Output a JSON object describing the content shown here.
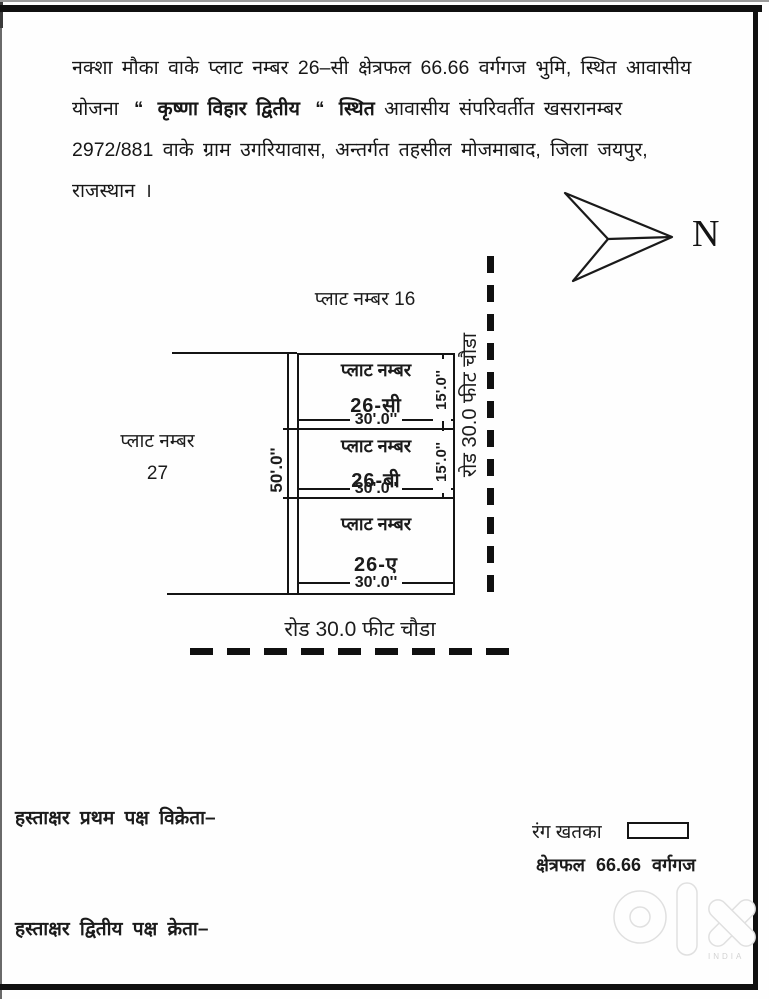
{
  "header_paragraph": {
    "line1": "नक्शा मौका वाके प्लाट नम्बर 26–सी क्षेत्रफल 66.66 वर्गगज भुमि, स्थित आवासीय",
    "line2_prefix": "योजना",
    "line2_quote_open": "‘‘",
    "line2_bold_name": "कृष्णा विहार द्वितीय",
    "line2_quote_close": "‘‘",
    "line2_bold_word": "स्थित",
    "line2_rest": "आवासीय संपरिवर्तीत खसरानम्बर",
    "line3": "2972/881 वाके ग्राम उगरियावास, अन्तर्गत तहसील मोजमाबाद, जिला जयपुर,",
    "line4": "राजस्थान ।"
  },
  "north": {
    "label": "N"
  },
  "diagram": {
    "adjacent_plot_top": "प्लाट नम्बर 16",
    "adjacent_plot_left_line1": "प्लाट नम्बर",
    "adjacent_plot_left_line2": "27",
    "sections": [
      {
        "title": "प्लाट नम्बर",
        "number": "26-सी",
        "width": "30'.0''"
      },
      {
        "title": "प्लाट नम्बर",
        "number": "26-बी",
        "width": "30'.0''"
      },
      {
        "title": "प्लाट नम्बर",
        "number": "26-ए",
        "width": "30'.0''"
      }
    ],
    "left_dimension": "50'.0''",
    "right_dimension_1": "15'.0''",
    "right_dimension_2": "15'.0''",
    "road_right_label": "रोड 30.0 फीट चौडा",
    "road_bottom_label": "रोड 30.0 फीट चौडा"
  },
  "footer": {
    "signature_seller": "हस्ताक्षर प्रथम पक्ष विक्रेता–",
    "signature_buyer": "हस्ताक्षर द्वितीय पक्ष क्रेता–",
    "legend_color_label": "रंग खतका",
    "legend_area_label": "क्षेत्रफल",
    "legend_area_value": "66.66",
    "legend_area_unit": "वर्गगज"
  },
  "watermark": {
    "country": "INDIA"
  }
}
